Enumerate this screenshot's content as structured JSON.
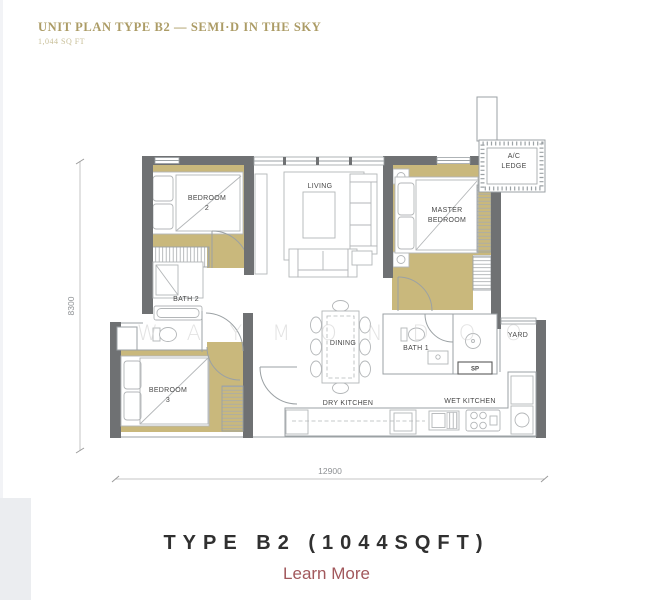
{
  "header": {
    "title": "UNIT PLAN TYPE B2 — SEMI·D IN THE SKY",
    "subtitle": "1,044 SQ FT",
    "title_color": "#ac9c66"
  },
  "floorplan": {
    "watermark": "WAYMONDOO",
    "wall_color": "#6f7173",
    "floor_color": "#c9b87c",
    "line_color": "#9ba1a4",
    "labels": {
      "bedroom2_line1": "BEDROOM",
      "bedroom2_line2": "2",
      "living": "LIVING",
      "master_line1": "MASTER",
      "master_line2": "BEDROOM",
      "ac_line1": "A/C",
      "ac_line2": "LEDGE",
      "bath2": "BATH 2",
      "dining": "DINING",
      "bath1": "BATH 1",
      "sp": "SP",
      "yard": "YARD",
      "bedroom3_line1": "BEDROOM",
      "bedroom3_line2": "3",
      "dry_kitchen": "DRY KITCHEN",
      "wet_kitchen": "WET KITCHEN"
    },
    "dimensions": {
      "width": "12900",
      "height": "8300"
    }
  },
  "footer": {
    "title": "TYPE B2 (1044SQFT)",
    "link_label": "Learn More",
    "link_color": "#a2585c"
  }
}
